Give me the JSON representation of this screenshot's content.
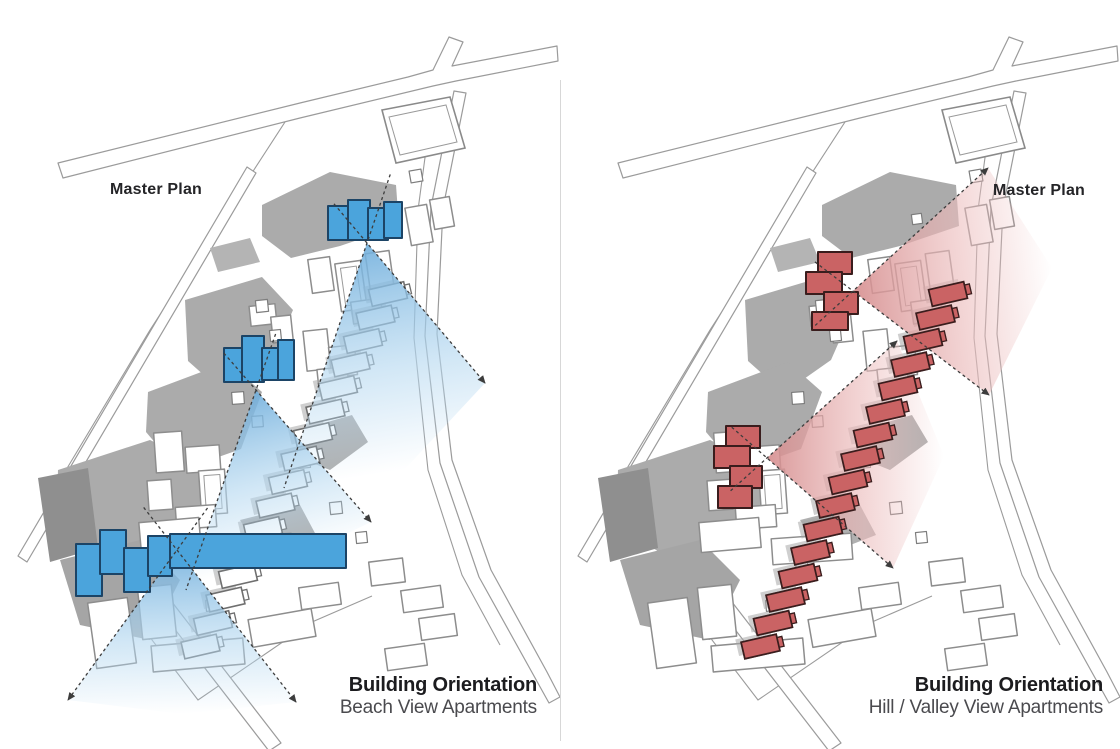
{
  "page": {
    "background": "#ffffff",
    "divider_color": "#d7d7d7"
  },
  "panels": [
    {
      "id": "left",
      "master_plan_label": "Master Plan",
      "master_plan_pos": {
        "x": 110,
        "y": 181
      },
      "caption_title": "Building Orientation",
      "caption_subtitle": "Beach View Apartments",
      "caption_right": 583,
      "caption_top": 674,
      "theme": {
        "building_fill": "#4BA4DC",
        "building_stroke": "#1C4466",
        "cone_start": "#6FAEDC",
        "cone_mid": "#B5D8F0",
        "ray_color": "#3d3d3d"
      },
      "highlight_buildings": [
        [
          [
            328,
            206,
            22,
            34
          ],
          [
            348,
            200,
            22,
            40
          ],
          [
            368,
            208,
            20,
            32
          ],
          [
            384,
            202,
            18,
            36
          ]
        ],
        [
          [
            224,
            348,
            20,
            34
          ],
          [
            242,
            336,
            22,
            46
          ],
          [
            262,
            348,
            18,
            32
          ],
          [
            278,
            340,
            16,
            40
          ]
        ],
        [
          [
            76,
            544,
            26,
            52
          ],
          [
            100,
            530,
            26,
            44
          ],
          [
            124,
            548,
            26,
            44
          ],
          [
            148,
            536,
            24,
            40
          ],
          [
            170,
            534,
            176,
            34
          ]
        ]
      ],
      "cones": [
        {
          "apex": [
            367,
            243
          ],
          "far": [
            [
              284,
              488
            ],
            [
              404,
              470
            ],
            [
              485,
              383
            ]
          ],
          "rays": [
            {
              "to": [
                284,
                488
              ],
              "arrow": false
            },
            {
              "to": [
                485,
                383
              ],
              "arrow": true
            }
          ]
        },
        {
          "apex": [
            256,
            390
          ],
          "far": [
            [
              186,
              590
            ],
            [
              300,
              556
            ],
            [
              371,
              522
            ]
          ],
          "rays": [
            {
              "to": [
                186,
                590
              ],
              "arrow": false
            },
            {
              "to": [
                371,
                522
              ],
              "arrow": true
            }
          ]
        },
        {
          "apex": [
            177,
            550
          ],
          "far": [
            [
              68,
              700
            ],
            [
              182,
              714
            ],
            [
              296,
              702
            ]
          ],
          "rays": [
            {
              "to": [
                68,
                700
              ],
              "arrow": true
            },
            {
              "to": [
                296,
                702
              ],
              "arrow": true
            }
          ]
        }
      ],
      "staircase_highlight": false
    },
    {
      "id": "right",
      "master_plan_label": "Master Plan",
      "master_plan_pos": {
        "x": 993,
        "y": 182
      },
      "caption_title": "Building Orientation",
      "caption_subtitle": "Hill / Valley View Apartments",
      "caption_right": 17,
      "caption_top": 674,
      "theme": {
        "building_fill": "#CA6364",
        "building_stroke": "#3A1D1D",
        "cone_start": "#D58C8D",
        "cone_mid": "#ECBDBD",
        "ray_color": "#3d3d3d"
      },
      "highlight_buildings": [
        [
          [
            258,
            252,
            34,
            22
          ],
          [
            246,
            272,
            36,
            22
          ],
          [
            264,
            292,
            34,
            22
          ],
          [
            252,
            312,
            36,
            18
          ]
        ],
        [
          [
            166,
            426,
            34,
            22
          ],
          [
            154,
            446,
            36,
            22
          ],
          [
            170,
            466,
            32,
            22
          ],
          [
            158,
            486,
            34,
            22
          ]
        ]
      ],
      "cones": [
        {
          "apex": [
            293,
            291
          ],
          "far": [
            [
              428,
              168
            ],
            [
              492,
              268
            ],
            [
              429,
              395
            ]
          ],
          "rays": [
            {
              "to": [
                428,
                168
              ],
              "arrow": true
            },
            {
              "to": [
                429,
                395
              ],
              "arrow": true
            }
          ]
        },
        {
          "apex": [
            207,
            458
          ],
          "far": [
            [
              337,
              341
            ],
            [
              384,
              456
            ],
            [
              333,
              568
            ]
          ],
          "rays": [
            {
              "to": [
                337,
                341
              ],
              "arrow": true
            },
            {
              "to": [
                333,
                568
              ],
              "arrow": true
            }
          ]
        }
      ],
      "staircase_highlight": true
    }
  ],
  "base_plan": {
    "road_fill": "#ffffff",
    "road_stroke": "#9b9b9b",
    "site_line_color": "#9b9b9b",
    "context_mass_fill": "#ababab",
    "context_building_stroke": "#8d8d8d",
    "rowhouse_stroke": "#6f6f6f",
    "roads": [
      {
        "points": "58,163 300,103 408,77 433,70 449,37 463,42 452,66 557,46 558,61 456,81 433,86 300,118 63,178"
      },
      {
        "points": "466,93 443,208 437,334 452,460 491,570 547,672 560,697 549,703 479,577 440,463 425,336 431,207 454,91"
      },
      {
        "points": "247,167 256,173 27,562 18,556"
      },
      {
        "points": "153,601 165,593 281,743 269,751"
      }
    ],
    "site_lines": [
      {
        "points": "285,122 150,330 60,480 27,548"
      },
      {
        "points": "96,548 152,640 198,700 312,622 372,596"
      },
      {
        "points": "430,120 418,210 414,338 428,470 462,575 500,645"
      }
    ],
    "parallelogram": {
      "outer": "382,110 450,97 465,148 396,163",
      "inner": "389,117 446,105 457,142 400,155"
    },
    "gray_masses": [
      {
        "points": "262,205 330,172 396,185 399,226 340,246 291,258 262,236",
        "fill": "#ababab"
      },
      {
        "points": "185,300 262,277 293,310 271,360 224,393 188,361",
        "fill": "#ababab"
      },
      {
        "points": "148,392 228,362 262,392 241,449 179,471 146,432",
        "fill": "#ababab"
      },
      {
        "points": "58,470 150,440 212,470 200,532 118,562 56,528",
        "fill": "#ababab"
      },
      {
        "points": "38,478 88,468 98,548 50,562",
        "fill": "#8f8f8f"
      },
      {
        "points": "210,248 250,238 260,262 218,272",
        "fill": "#b4b4b4"
      },
      {
        "points": "300,430 352,415 368,442 330,470 300,458",
        "fill": "#b0b0b0"
      },
      {
        "points": "240,520 300,505 316,535 262,556",
        "fill": "#b0b0b0"
      },
      {
        "points": "60,560 140,540 180,580 150,640 80,625",
        "fill": "#a5a5a5"
      }
    ],
    "white_buildings": [
      {
        "x": 310,
        "y": 258,
        "w": 22,
        "h": 34,
        "r": -8
      },
      {
        "x": 338,
        "y": 262,
        "w": 26,
        "h": 48,
        "r": -8,
        "inner": true
      },
      {
        "x": 368,
        "y": 252,
        "w": 24,
        "h": 42,
        "r": -8
      },
      {
        "x": 352,
        "y": 300,
        "w": 30,
        "h": 22,
        "r": -8
      },
      {
        "x": 408,
        "y": 206,
        "w": 22,
        "h": 38,
        "r": -10
      },
      {
        "x": 432,
        "y": 198,
        "w": 20,
        "h": 30,
        "r": -10
      },
      {
        "x": 250,
        "y": 305,
        "w": 26,
        "h": 20,
        "r": -6
      },
      {
        "x": 272,
        "y": 316,
        "w": 20,
        "h": 26,
        "r": -6
      },
      {
        "x": 305,
        "y": 330,
        "w": 24,
        "h": 40,
        "r": -6
      },
      {
        "x": 330,
        "y": 346,
        "w": 26,
        "h": 30,
        "r": -6
      },
      {
        "x": 318,
        "y": 368,
        "w": 30,
        "h": 22,
        "r": -6
      },
      {
        "x": 155,
        "y": 432,
        "w": 28,
        "h": 40,
        "r": -4
      },
      {
        "x": 186,
        "y": 446,
        "w": 34,
        "h": 26,
        "r": -4
      },
      {
        "x": 200,
        "y": 470,
        "w": 26,
        "h": 44,
        "r": -4,
        "inner": true
      },
      {
        "x": 148,
        "y": 480,
        "w": 24,
        "h": 30,
        "r": -4
      },
      {
        "x": 176,
        "y": 506,
        "w": 40,
        "h": 22,
        "r": -4
      },
      {
        "x": 140,
        "y": 520,
        "w": 60,
        "h": 30,
        "r": -5
      },
      {
        "x": 212,
        "y": 536,
        "w": 80,
        "h": 26,
        "r": -4
      },
      {
        "x": 370,
        "y": 560,
        "w": 34,
        "h": 24,
        "r": -7
      },
      {
        "x": 402,
        "y": 588,
        "w": 40,
        "h": 22,
        "r": -8
      },
      {
        "x": 420,
        "y": 616,
        "w": 36,
        "h": 22,
        "r": -8
      },
      {
        "x": 386,
        "y": 646,
        "w": 40,
        "h": 22,
        "r": -8
      },
      {
        "x": 92,
        "y": 600,
        "w": 40,
        "h": 66,
        "r": -8
      },
      {
        "x": 140,
        "y": 586,
        "w": 34,
        "h": 52,
        "r": -6
      },
      {
        "x": 152,
        "y": 642,
        "w": 92,
        "h": 26,
        "r": -5
      },
      {
        "x": 250,
        "y": 614,
        "w": 64,
        "h": 28,
        "r": -10
      },
      {
        "x": 300,
        "y": 585,
        "w": 40,
        "h": 22,
        "r": -8
      }
    ],
    "tiny_buildings": [
      {
        "x": 256,
        "y": 300,
        "w": 12,
        "h": 12,
        "r": -6
      },
      {
        "x": 270,
        "y": 330,
        "w": 11,
        "h": 11,
        "r": -6
      },
      {
        "x": 232,
        "y": 392,
        "w": 12,
        "h": 12,
        "r": -4
      },
      {
        "x": 252,
        "y": 416,
        "w": 11,
        "h": 11,
        "r": -4
      },
      {
        "x": 298,
        "y": 456,
        "w": 12,
        "h": 12,
        "r": -5
      },
      {
        "x": 272,
        "y": 482,
        "w": 11,
        "h": 11,
        "r": -5
      },
      {
        "x": 330,
        "y": 502,
        "w": 12,
        "h": 12,
        "r": -6
      },
      {
        "x": 356,
        "y": 532,
        "w": 11,
        "h": 11,
        "r": -6
      },
      {
        "x": 236,
        "y": 562,
        "w": 12,
        "h": 12,
        "r": -5
      },
      {
        "x": 206,
        "y": 600,
        "w": 11,
        "h": 11,
        "r": -5
      },
      {
        "x": 410,
        "y": 170,
        "w": 12,
        "h": 12,
        "r": -10
      },
      {
        "x": 352,
        "y": 214,
        "w": 10,
        "h": 10,
        "r": -8
      }
    ],
    "staircase": {
      "x": 388,
      "y": 294,
      "dx": -12.5,
      "dy": 23.5,
      "count": 16,
      "w": 36,
      "h": 17,
      "r": -13,
      "stub_w": 7,
      "stub_h": 10
    }
  }
}
